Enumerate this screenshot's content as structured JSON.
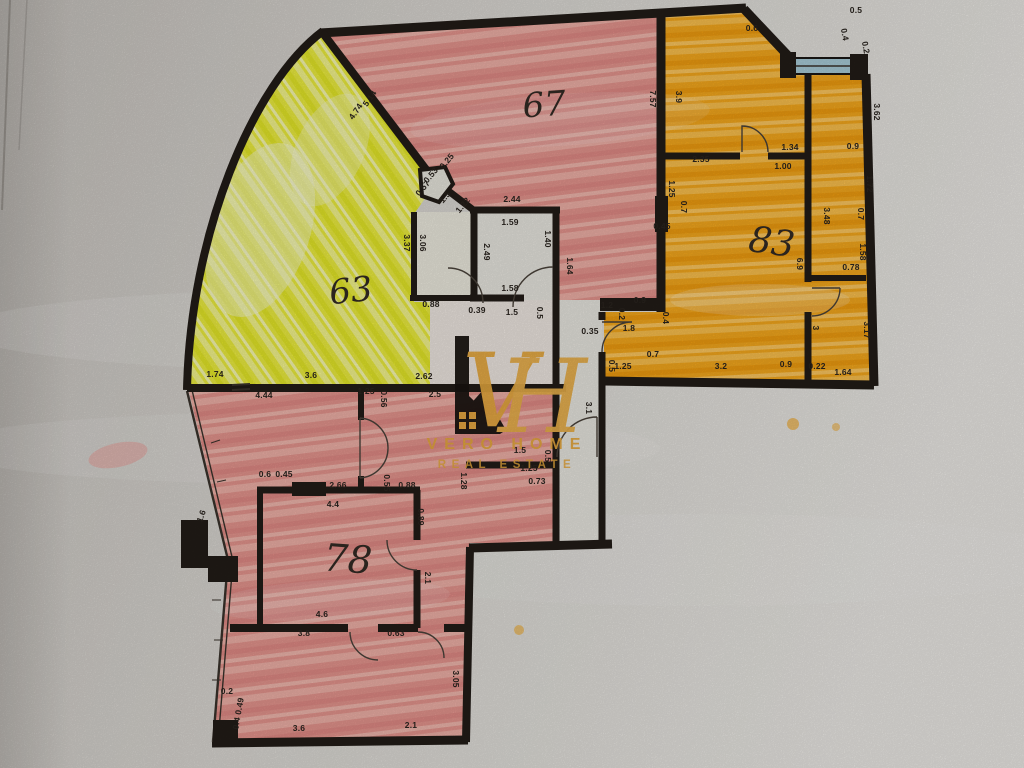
{
  "photo": {
    "subject": "hand-coloured apartment floor plan, photographed on textured paper"
  },
  "logo": {
    "monogram_v": "V",
    "monogram_h": "H",
    "name": "VERO HOME",
    "tagline": "REAL ESTATE",
    "gold": "#e7a93e",
    "house_black": "#191410"
  },
  "colors": {
    "pink_marker": "#e89b94",
    "yellow_marker": "#eef04c",
    "orange_marker": "#f6ab1e",
    "paper": "#dbd8d3",
    "wall_ink": "#221c17",
    "window_glass": "#a8ccd8"
  },
  "rooms": [
    {
      "number": "67",
      "x": 545,
      "y": 116,
      "size": 34,
      "rot": -4
    },
    {
      "number": "63",
      "x": 352,
      "y": 302,
      "size": 34,
      "rot": -6
    },
    {
      "number": "83",
      "x": 770,
      "y": 254,
      "size": 36,
      "rot": 8
    },
    {
      "number": "78",
      "x": 347,
      "y": 572,
      "size": 38,
      "rot": 4
    }
  ],
  "dimensions": [
    [
      "5.14",
      372,
      100,
      -55
    ],
    [
      "4.74",
      358,
      113,
      -55
    ],
    [
      "0.25",
      449,
      163,
      -50
    ],
    [
      "0.53",
      433,
      177,
      -50
    ],
    [
      "0.57",
      425,
      190,
      -50
    ],
    [
      "1.5",
      447,
      199,
      -50
    ],
    [
      "1.22",
      465,
      207,
      -50
    ],
    [
      "2.44",
      512,
      202,
      0
    ],
    [
      "1.59",
      510,
      225,
      0
    ],
    [
      "1.40",
      545,
      239,
      90
    ],
    [
      "1.64",
      567,
      266,
      90
    ],
    [
      "2.49",
      484,
      252,
      90
    ],
    [
      "3.37",
      404,
      243,
      90
    ],
    [
      "3.06",
      420,
      243,
      90
    ],
    [
      "1.58",
      510,
      291,
      0
    ],
    [
      "1.5",
      512,
      315,
      0
    ],
    [
      "0.5",
      537,
      313,
      90
    ],
    [
      "0.39",
      477,
      313,
      0
    ],
    [
      "0.88",
      431,
      307,
      0
    ],
    [
      "7.57",
      650,
      99,
      90
    ],
    [
      "3.9",
      676,
      97,
      90
    ],
    [
      "0.6",
      752,
      31,
      0
    ],
    [
      "0.4",
      842,
      35,
      80
    ],
    [
      "0.5",
      856,
      13,
      0
    ],
    [
      "0.2",
      863,
      48,
      80
    ],
    [
      "3.62",
      874,
      112,
      90
    ],
    [
      "2.35",
      701,
      162,
      0
    ],
    [
      "1.34",
      790,
      150,
      0
    ],
    [
      "0.9",
      853,
      149,
      0
    ],
    [
      "1.00",
      783,
      169,
      0
    ],
    [
      "1.72",
      867,
      184,
      90
    ],
    [
      "1.25",
      669,
      189,
      90
    ],
    [
      "0.7",
      681,
      207,
      90
    ],
    [
      "0.45",
      662,
      229,
      0
    ],
    [
      "3.48",
      824,
      216,
      90
    ],
    [
      "0.7",
      858,
      214,
      90
    ],
    [
      "1.58",
      860,
      252,
      90
    ],
    [
      "0.78",
      851,
      270,
      0
    ],
    [
      "6.9",
      797,
      264,
      90
    ],
    [
      "3",
      813,
      328,
      90
    ],
    [
      "3.17",
      864,
      330,
      90
    ],
    [
      "1.2",
      607,
      308,
      0
    ],
    [
      "0.2",
      619,
      314,
      90
    ],
    [
      "0.9",
      640,
      303,
      0
    ],
    [
      "0.4",
      663,
      318,
      90
    ],
    [
      "0.35",
      590,
      334,
      0
    ],
    [
      "1.8",
      629,
      331,
      0
    ],
    [
      "0.5",
      609,
      366,
      90
    ],
    [
      "1.25",
      623,
      369,
      0
    ],
    [
      "0.7",
      653,
      357,
      0
    ],
    [
      "3.2",
      721,
      369,
      0
    ],
    [
      "0.9",
      786,
      367,
      0
    ],
    [
      "0.22",
      817,
      369,
      0
    ],
    [
      "1.64",
      843,
      375,
      0
    ],
    [
      "3.1",
      586,
      408,
      90
    ],
    [
      "1.74",
      215,
      377,
      0
    ],
    [
      "3.6",
      311,
      378,
      0
    ],
    [
      "2.62",
      424,
      379,
      0
    ],
    [
      "4.44",
      264,
      398,
      0
    ],
    [
      "1.25",
      366,
      394,
      0
    ],
    [
      "0.56",
      381,
      399,
      90
    ],
    [
      "2.5",
      435,
      397,
      0
    ],
    [
      "1.6",
      204,
      517,
      -70
    ],
    [
      "0.6",
      265,
      477,
      0
    ],
    [
      "0.45",
      284,
      477,
      0
    ],
    [
      "2.66",
      338,
      488,
      0
    ],
    [
      "0.55",
      384,
      483,
      90
    ],
    [
      "0.88",
      407,
      488,
      0
    ],
    [
      "4.4",
      333,
      507,
      0
    ],
    [
      "0.89",
      418,
      517,
      90
    ],
    [
      "1.28",
      461,
      481,
      90
    ],
    [
      "1.25",
      529,
      471,
      0
    ],
    [
      "0.73",
      537,
      484,
      0
    ],
    [
      "1.5",
      520,
      453,
      0
    ],
    [
      "0.5",
      545,
      456,
      90
    ],
    [
      "4.6",
      322,
      617,
      0
    ],
    [
      "3.8",
      304,
      636,
      0
    ],
    [
      "0.63",
      396,
      636,
      0
    ],
    [
      "2.1",
      425,
      578,
      90
    ],
    [
      "3.05",
      453,
      679,
      90
    ],
    [
      "3.6",
      299,
      731,
      0
    ],
    [
      "2.1",
      411,
      728,
      0
    ],
    [
      "0.2",
      227,
      694,
      0
    ],
    [
      "0.4 0.49",
      241,
      714,
      -80
    ]
  ]
}
